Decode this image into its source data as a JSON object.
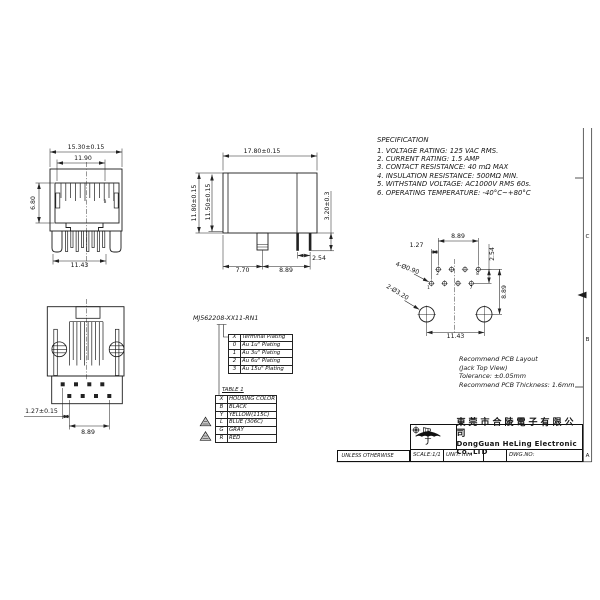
{
  "specification": {
    "title": "SPECIFICATION",
    "items": [
      "1. VOLTAGE RATING: 125 VAC RMS.",
      "2. CURRENT RATING: 1.5 AMP",
      "3. CONTACT RESISTANCE: 40 mΩ MAX",
      "4. INSULATION RESISTANCE: 500MΩ MIN.",
      "5. WITHSTAND VOLTAGE: AC1000V RMS 60s.",
      "6. OPERATING TEMPERATURE: -40°C~+80°C"
    ]
  },
  "part_number": "MJ562208-XX11-RN1",
  "views": {
    "front": {
      "dim_outer_width": "15.30±0.15",
      "dim_inner_width": "11.90",
      "dim_opening_height": "6.80",
      "dim_leg_span": "11.43",
      "pin_label": "8"
    },
    "side": {
      "dim_width": "17.80±0.15",
      "dim_height_outer": "11.80±0.15",
      "dim_height_inner": "11.50±0.15",
      "dim_pin_length": "3.20±0.3",
      "dim_pin_pitch": "2.54",
      "dim_post_offset": "7.70",
      "dim_pin_span": "8.89"
    },
    "bottom": {
      "dim_row_offset": "1.27±0.15",
      "dim_pin_span": "8.89"
    },
    "pcb": {
      "dim_top_span": "8.89",
      "dim_hole_offset": "1.27",
      "dim_row_pitch": "2.54",
      "small_holes_label": "4-Ø0.90",
      "large_holes_label": "2-Ø3.20",
      "dim_right_span": "8.89",
      "dim_mount_span": "11.43",
      "pin_labels": {
        "p2": "2",
        "p8": "8",
        "p1": "1",
        "p7": "7"
      },
      "caption": [
        "Recommend PCB Layout",
        "(Jack Top View)",
        "Tolerance: ±0.05mm",
        "Recommend PCB Thickness: 1.6mm"
      ]
    }
  },
  "plating_table": {
    "header": {
      "code": "X",
      "label": "Terminal Plating"
    },
    "rows": [
      {
        "code": "0",
        "label": "Au 1u\" Plating"
      },
      {
        "code": "1",
        "label": "Au 3u\" Plating"
      },
      {
        "code": "2",
        "label": "Au 6u\" Plating"
      },
      {
        "code": "3",
        "label": "Au 15u\" Plating"
      }
    ]
  },
  "color_table": {
    "title": "TABLE 1",
    "header": {
      "code": "X",
      "label": "HOUSING COLOR"
    },
    "rows": [
      {
        "code": "B",
        "label": "BLACK"
      },
      {
        "code": "Y",
        "label": "YELLOW(115C)"
      },
      {
        "code": "L",
        "label": "BLUE (306C)"
      },
      {
        "code": "G",
        "label": "GRAY"
      },
      {
        "code": "R",
        "label": "RED"
      }
    ]
  },
  "title_block": {
    "unless_note": "UNLESS OTHERWISE",
    "company_cn": "東莞市合陵電子有限公司",
    "company_en": "DongGuan HeLing Electronic Co.,LTD",
    "scale": "SCALE:1/1",
    "unit": "UNIT: mm",
    "dwg_no": "DWG.NO:"
  },
  "border": {
    "zone_c": "C",
    "zone_b": "B",
    "zone_a": "A"
  }
}
